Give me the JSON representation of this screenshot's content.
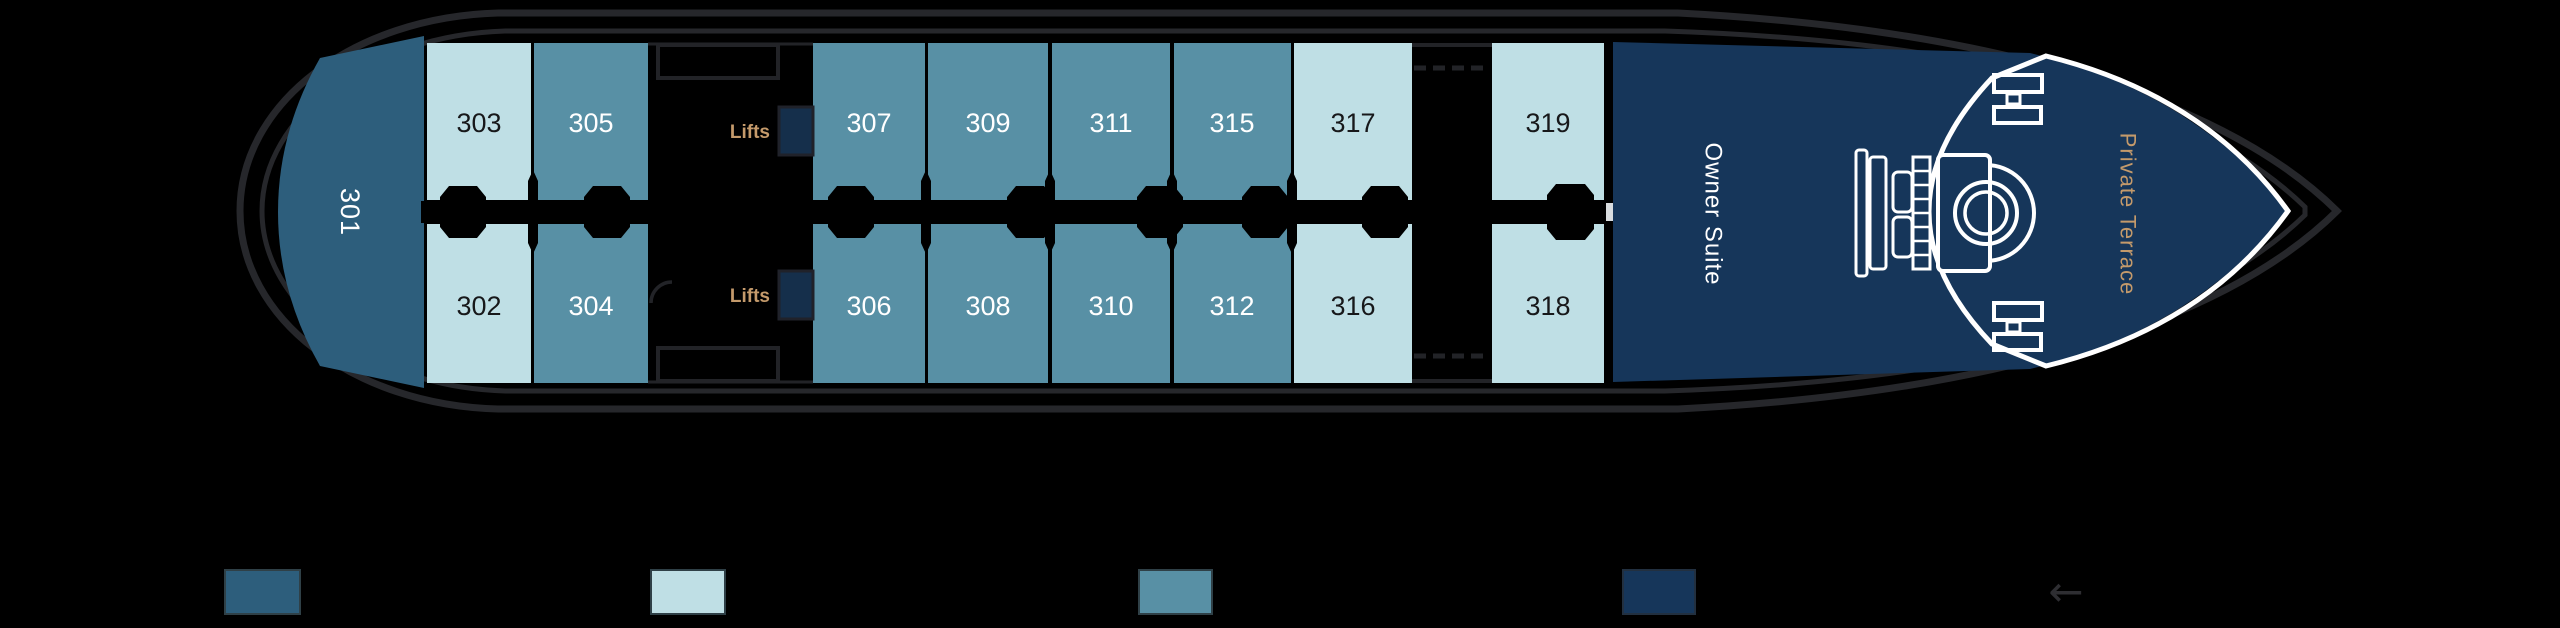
{
  "palette": {
    "background": "#000000",
    "hull_line": "#26272b",
    "structure_line": "#222327",
    "suite_stern": "#2d5e7c",
    "cabin_light": "#bfdfe5",
    "cabin_teal": "#5890a5",
    "suite_navy": "#16365a",
    "lift_navy": "#152f4b",
    "gold": "#c49a6b",
    "white": "#ffffff",
    "number_dark": "#17181a",
    "door_marker": "#d9dde0",
    "arrow_grey": "#2e2e32"
  },
  "labels": {
    "lifts": "Lifts",
    "owner_suite": "Owner Suite",
    "private_terrace": "Private Terrace"
  },
  "cabins": {
    "c301": {
      "number": "301"
    },
    "c302": {
      "number": "302"
    },
    "c303": {
      "number": "303"
    },
    "c304": {
      "number": "304"
    },
    "c305": {
      "number": "305"
    },
    "c306": {
      "number": "306"
    },
    "c307": {
      "number": "307"
    },
    "c308": {
      "number": "308"
    },
    "c309": {
      "number": "309"
    },
    "c310": {
      "number": "310"
    },
    "c311": {
      "number": "311"
    },
    "c312": {
      "number": "312"
    },
    "c315": {
      "number": "315"
    },
    "c316": {
      "number": "316"
    },
    "c317": {
      "number": "317"
    },
    "c318": {
      "number": "318"
    },
    "c319": {
      "number": "319"
    }
  },
  "legend": {
    "arrow": "←",
    "swatches": [
      {
        "name": "owner-suite-stern",
        "color": "#2d5e7c"
      },
      {
        "name": "cabin-light",
        "color": "#bfdfe5"
      },
      {
        "name": "cabin-teal",
        "color": "#5890a5"
      },
      {
        "name": "suite-navy",
        "color": "#16365a"
      }
    ]
  }
}
